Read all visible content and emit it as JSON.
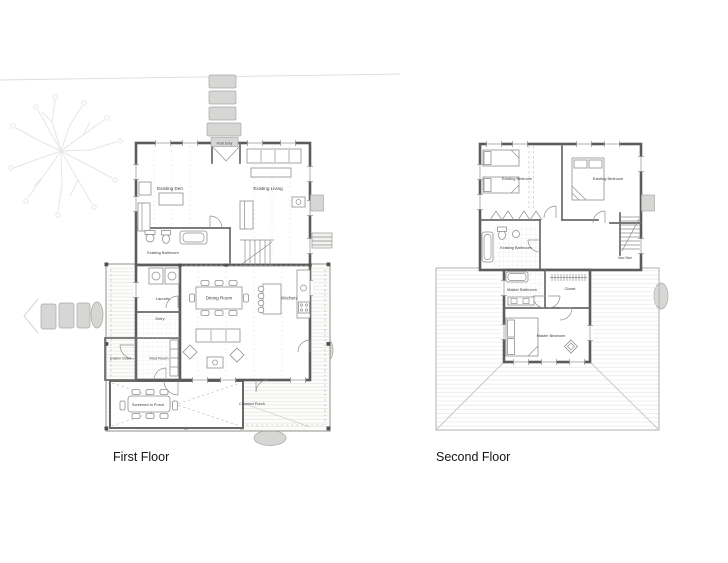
{
  "drawing": {
    "first_floor": {
      "title": "First Floor",
      "rooms": {
        "front_entry": "Front Entry",
        "existing_den": "Existing Den",
        "existing_living": "Existing Living",
        "existing_bathroom": "Existing Bathroom",
        "laundry": "Laundry",
        "entry": "Entry",
        "dining_room": "Dining Room",
        "kitchen": "Kitchen",
        "exterior_closet": "Exterior Closet",
        "mud_room": "Mud Room",
        "screened_in_porch": "Screened-in Porch",
        "covered_porch": "Covered Porch"
      }
    },
    "second_floor": {
      "title": "Second Floor",
      "rooms": {
        "existing_bedroom_left": "Existing Bedroom",
        "existing_bedroom_right": "Existing Bedroom",
        "existing_bathroom": "Existing Bathroom",
        "master_bathroom": "Master Bathroom",
        "closet": "Closet",
        "master_bedroom": "Master Bedroom",
        "new_stair": "New Stair"
      }
    },
    "colors": {
      "wall": "#5c5c5c",
      "stone_fill": "#d6d6d4",
      "light_line": "#e4e4e2",
      "label_text": "#3c3c3c"
    }
  }
}
